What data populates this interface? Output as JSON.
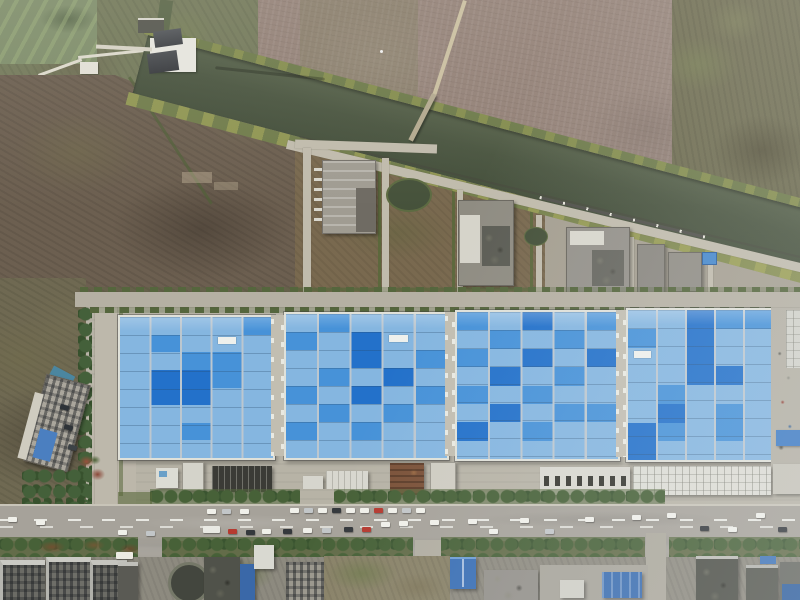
{
  "meta": {
    "description": "Aerial drone photograph of an industrial plant with four large blue-roofed factory halls beside an irrigation canal, plowed fields, a main road with traffic, and residential blocks at the bottom edge",
    "image_type": "aerial photograph"
  },
  "palette": {
    "canal_water": "#4a5540",
    "pond_water": "#7e8d6a",
    "field_mauve": "#938177",
    "field_brown": "#6c5f50",
    "scrub_olive": "#6d6b4f",
    "path_light": "#c0bbac",
    "apron_gray": "#b7b3a6",
    "road_asphalt": "#a6a29a",
    "roof_blue_light": "#85b6e0",
    "roof_blue_mid": "#4792d8",
    "roof_blue_dark": "#2371ca",
    "roof_edge_white": "#e0e1d9",
    "tree_green": "#44603a",
    "hedge_green": "#586838",
    "rust_brown": "#7b5239",
    "blue_accent": "#3a6db0"
  },
  "scene": {
    "labels": {
      "pond": "algae pond",
      "canal": "irrigation canal",
      "pump_station": "canal pump station",
      "footbridge": "footbridge over canal",
      "field_top_right": "plowed farmland",
      "field_left": "fallow scrub field",
      "treatment_area": "utility plots with treatment buildings and ponds",
      "factory": "four blue-roofed factory halls",
      "service_strip": "loading docks and service sheds",
      "main_road": "main road with traffic",
      "office": "curved office building",
      "bottom_blocks": "residential and industrial blocks"
    },
    "factory": {
      "halls": [
        {
          "id": "hall-1",
          "cols": 5,
          "rows": 8,
          "panels": [
            [
              1,
              1,
              0
            ],
            [
              4,
              0,
              0
            ],
            [
              2,
              2,
              0
            ],
            [
              1,
              3,
              1
            ],
            [
              1,
              4,
              1
            ],
            [
              2,
              3,
              1
            ],
            [
              2,
              4,
              1
            ],
            [
              3,
              2,
              0
            ],
            [
              3,
              3,
              0
            ],
            [
              2,
              6,
              0
            ]
          ],
          "white_units": [
            [
              3,
              1
            ]
          ]
        },
        {
          "id": "hall-2",
          "cols": 5,
          "rows": 8,
          "panels": [
            [
              1,
              0,
              0
            ],
            [
              0,
              1,
              0
            ],
            [
              2,
              1,
              1
            ],
            [
              2,
              2,
              1
            ],
            [
              4,
              2,
              0
            ],
            [
              1,
              3,
              0
            ],
            [
              3,
              3,
              1
            ],
            [
              0,
              4,
              0
            ],
            [
              2,
              4,
              1
            ],
            [
              4,
              4,
              0
            ],
            [
              1,
              5,
              0
            ],
            [
              3,
              5,
              0
            ],
            [
              2,
              6,
              0
            ],
            [
              0,
              6,
              0
            ]
          ],
          "white_units": [
            [
              3,
              1
            ]
          ]
        },
        {
          "id": "hall-3",
          "cols": 5,
          "rows": 8,
          "panels": [
            [
              0,
              0,
              0
            ],
            [
              2,
              0,
              1
            ],
            [
              4,
              0,
              0
            ],
            [
              1,
              1,
              0
            ],
            [
              3,
              1,
              0
            ],
            [
              0,
              2,
              0
            ],
            [
              2,
              2,
              1
            ],
            [
              4,
              2,
              1
            ],
            [
              1,
              3,
              1
            ],
            [
              3,
              3,
              0
            ],
            [
              0,
              4,
              0
            ],
            [
              2,
              4,
              0
            ],
            [
              1,
              5,
              1
            ],
            [
              3,
              5,
              0
            ],
            [
              4,
              5,
              0
            ],
            [
              2,
              6,
              0
            ],
            [
              0,
              6,
              1
            ]
          ],
          "white_units": []
        },
        {
          "id": "hall-4",
          "cols": 5,
          "rows": 8,
          "panels": [
            [
              2,
              0,
              1
            ],
            [
              3,
              0,
              0
            ],
            [
              2,
              1,
              1
            ],
            [
              0,
              1,
              0
            ],
            [
              4,
              0,
              0
            ],
            [
              2,
              2,
              1
            ],
            [
              2,
              3,
              1
            ],
            [
              3,
              3,
              1
            ],
            [
              1,
              4,
              0
            ],
            [
              3,
              5,
              0
            ],
            [
              1,
              5,
              1
            ],
            [
              0,
              6,
              1
            ],
            [
              1,
              6,
              0
            ],
            [
              0,
              7,
              1
            ],
            [
              3,
              6,
              0
            ]
          ],
          "white_units": [
            [
              0,
              2
            ]
          ]
        }
      ]
    },
    "road": {
      "car_colors": {
        "white": "#f0f0ea",
        "silver": "#c2c6c8",
        "dark": "#34383c",
        "red": "#b53a30",
        "truck": "#e9e9e3"
      },
      "cars": [
        {
          "x": 8,
          "y": 517,
          "c": "white"
        },
        {
          "x": 36,
          "y": 520,
          "c": "white"
        },
        {
          "x": 118,
          "y": 530,
          "c": "white"
        },
        {
          "x": 146,
          "y": 531,
          "c": "silver"
        },
        {
          "x": 203,
          "y": 526,
          "c": "truck"
        },
        {
          "x": 228,
          "y": 529,
          "c": "red"
        },
        {
          "x": 246,
          "y": 530,
          "c": "dark"
        },
        {
          "x": 262,
          "y": 529,
          "c": "white"
        },
        {
          "x": 283,
          "y": 529,
          "c": "dark"
        },
        {
          "x": 303,
          "y": 528,
          "c": "white"
        },
        {
          "x": 322,
          "y": 528,
          "c": "silver"
        },
        {
          "x": 344,
          "y": 527,
          "c": "dark"
        },
        {
          "x": 362,
          "y": 527,
          "c": "red"
        },
        {
          "x": 381,
          "y": 522,
          "c": "white"
        },
        {
          "x": 399,
          "y": 521,
          "c": "white"
        },
        {
          "x": 430,
          "y": 520,
          "c": "white"
        },
        {
          "x": 468,
          "y": 519,
          "c": "white"
        },
        {
          "x": 489,
          "y": 529,
          "c": "white"
        },
        {
          "x": 520,
          "y": 518,
          "c": "white"
        },
        {
          "x": 545,
          "y": 529,
          "c": "silver"
        },
        {
          "x": 585,
          "y": 517,
          "c": "white"
        },
        {
          "x": 632,
          "y": 515,
          "c": "white"
        },
        {
          "x": 667,
          "y": 513,
          "c": "white"
        },
        {
          "x": 700,
          "y": 526,
          "c": "dark"
        },
        {
          "x": 728,
          "y": 527,
          "c": "white"
        },
        {
          "x": 756,
          "y": 513,
          "c": "white"
        },
        {
          "x": 778,
          "y": 527,
          "c": "dark"
        }
      ],
      "parked_cars": [
        {
          "x": 207,
          "y": 509,
          "c": "white"
        },
        {
          "x": 222,
          "y": 509,
          "c": "silver"
        },
        {
          "x": 240,
          "y": 509,
          "c": "white"
        },
        {
          "x": 290,
          "y": 508,
          "c": "white"
        },
        {
          "x": 304,
          "y": 508,
          "c": "silver"
        },
        {
          "x": 318,
          "y": 508,
          "c": "white"
        },
        {
          "x": 332,
          "y": 508,
          "c": "dark"
        },
        {
          "x": 346,
          "y": 508,
          "c": "white"
        },
        {
          "x": 360,
          "y": 508,
          "c": "white"
        },
        {
          "x": 374,
          "y": 508,
          "c": "red"
        },
        {
          "x": 388,
          "y": 508,
          "c": "white"
        },
        {
          "x": 402,
          "y": 508,
          "c": "silver"
        },
        {
          "x": 416,
          "y": 508,
          "c": "white"
        }
      ],
      "bus": {
        "x": 116,
        "y": 552,
        "w": 17,
        "h": 7,
        "color": "#eceae2"
      }
    }
  }
}
